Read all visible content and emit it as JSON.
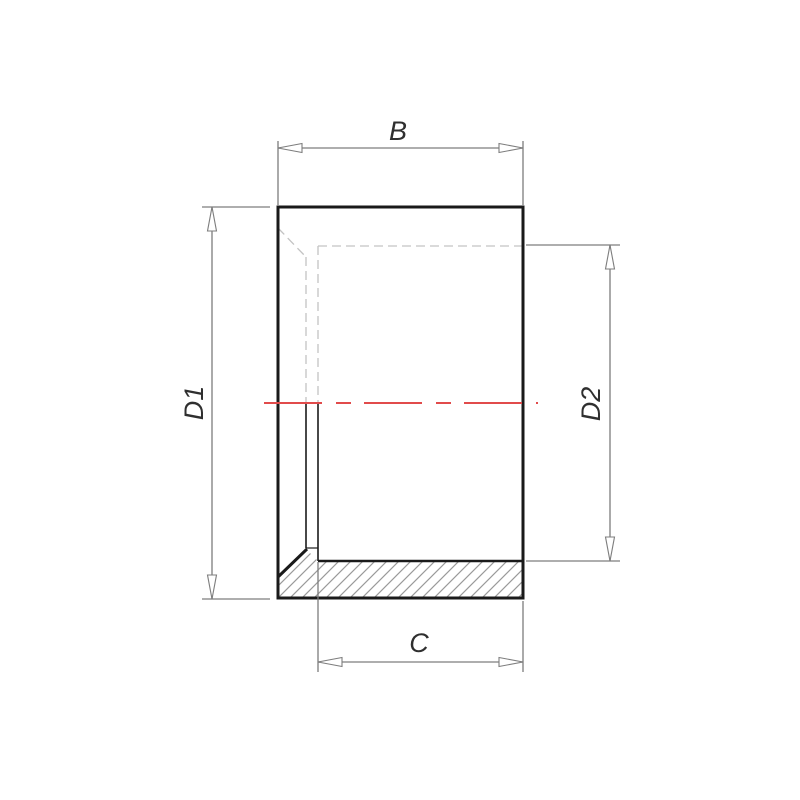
{
  "drawing": {
    "labels": {
      "width_top": "B",
      "outer_diameter_left": "D1",
      "inner_diameter_right": "D2",
      "socket_depth_bottom": "C"
    },
    "colors": {
      "outline": "#1a1a1a",
      "dimension_lines": "#7d7d7d",
      "hidden_lines": "#c3c3c3",
      "hatch_lines": "#9a9a9a",
      "centerline_red": "#e14b4b",
      "label_text": "#2f2f2f"
    }
  }
}
